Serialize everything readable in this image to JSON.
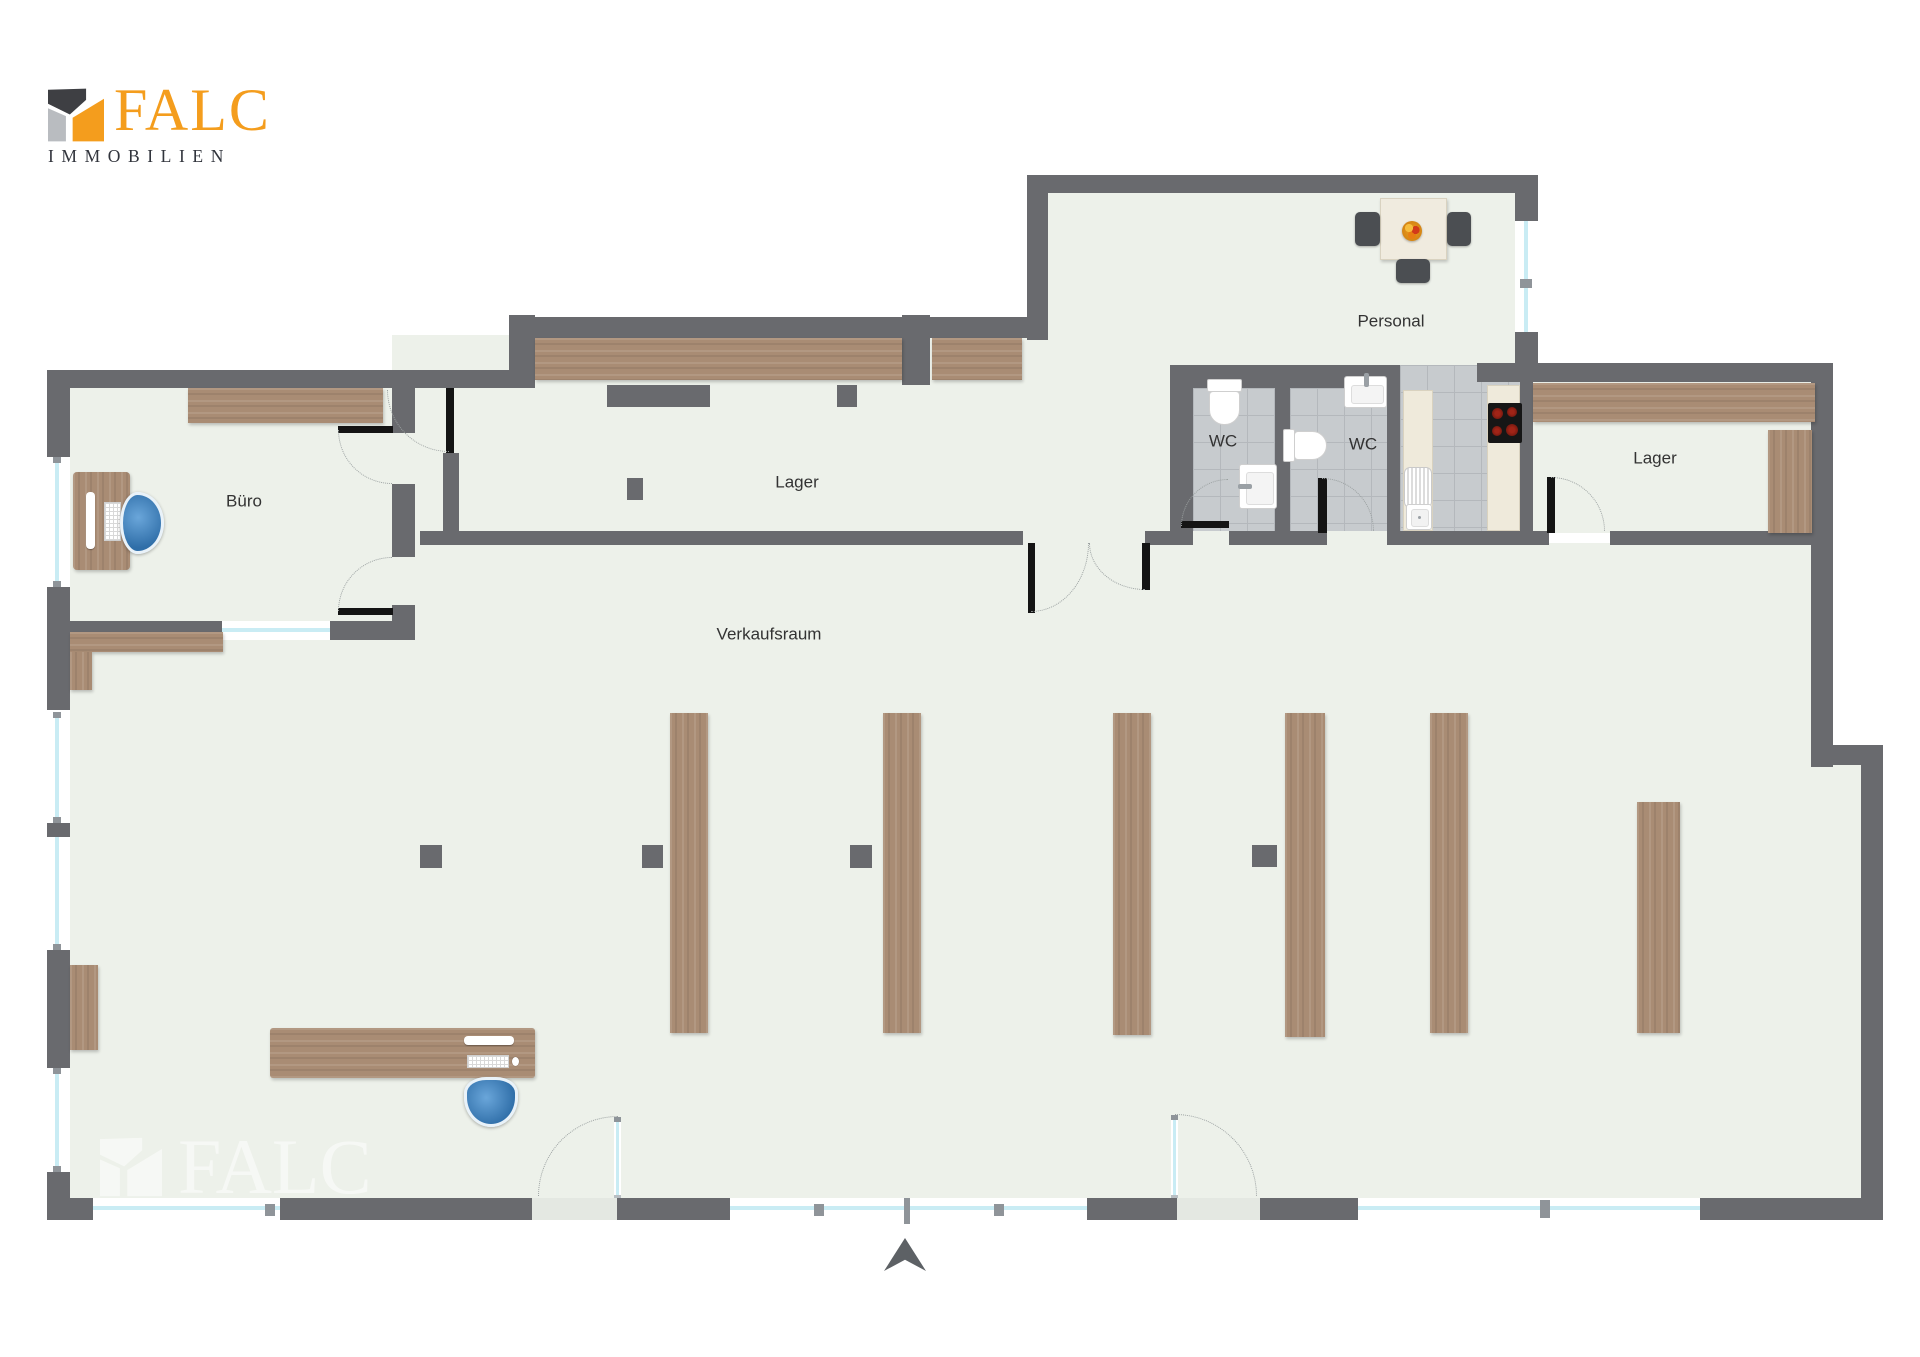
{
  "brand": {
    "logo_text": "FALC",
    "logo_subtext": "IMMOBILIEN",
    "watermark_text": "FALC"
  },
  "rooms": {
    "buero": "Büro",
    "lager_top": "Lager",
    "verkaufsraum": "Verkaufsraum",
    "wc_left": "WC",
    "wc_right": "WC",
    "personal": "Personal",
    "lager_right": "Lager"
  },
  "colors": {
    "wall": "#696a6e",
    "floor": "#edf1ea",
    "wood": "#a98c74",
    "tile": "#c7cbce",
    "tile_line": "#b4b8bc",
    "window_glass": "#c9ecf4",
    "brand_orange": "#F49D1D",
    "brand_dark": "#31343c",
    "logo_gray": "#b9bcc0",
    "chair_blue": "#3779bd",
    "door_black": "#141414",
    "counter_cream": "#efeadb",
    "label_text": "#333333",
    "arrow": "#5d6165"
  }
}
